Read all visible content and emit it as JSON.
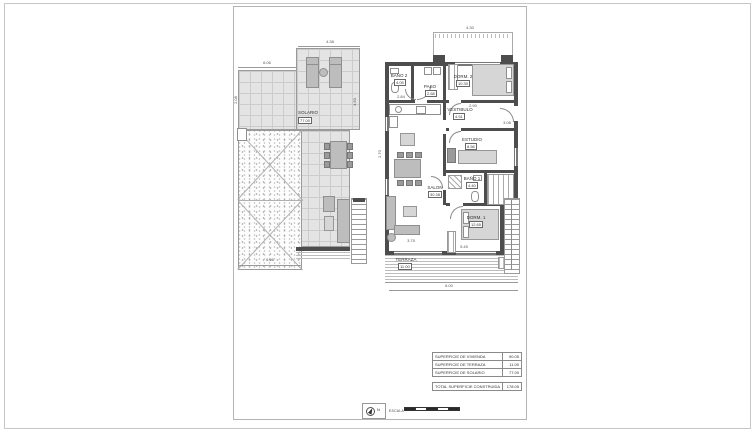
{
  "colors": {
    "wall": "#4d4d4d",
    "tile_fill": "#e4e4e4",
    "grid_line": "#cccccc",
    "furniture": "#bdbdbd",
    "paper": "#ffffff",
    "outline": "#9a9a9a",
    "text": "#3c3c3c",
    "scale_black": "#2a2a2a"
  },
  "solarium": {
    "label": "SOLARIO",
    "area": "77.00",
    "dims": {
      "top": "4.38",
      "upper": "6.06",
      "bottom": "6.06",
      "right": "4.50",
      "left": "2.08"
    }
  },
  "floor": {
    "rooms": {
      "bano2": {
        "name": "BAÑO 2",
        "area": "4.05"
      },
      "paso": {
        "name": "PASO",
        "area": "2.68"
      },
      "dorm2": {
        "name": "DORM. 2",
        "area": "10.30"
      },
      "vestibulo": {
        "name": "VESTIBULO",
        "area": "4.51"
      },
      "estudio": {
        "name": "ESTUDIO",
        "area": "8.56"
      },
      "bano1": {
        "name": "BAÑO 1",
        "area": "4.40"
      },
      "dorm1": {
        "name": "DORM. 1",
        "area": "12.65"
      },
      "salon": {
        "name": "SALON",
        "area": "30.38"
      },
      "terraza": {
        "name": "TERRAZA",
        "area": "11.00"
      }
    },
    "dims": {
      "left": "2.70",
      "bano2_below": "2.84",
      "dorm2_below": "2.90",
      "entry": "3.08",
      "patio": "4.30",
      "terraza_top": "5.45",
      "salon_bottom": "3.75",
      "bottom": "6.00"
    }
  },
  "area_table": {
    "rows": [
      {
        "label": "SUPERFICIE DE VIVIENDA",
        "value": "90.05"
      },
      {
        "label": "SUPERFICIE DE TERRAZA",
        "value": "11.00"
      },
      {
        "label": "SUPERFICIE DE SOLARIO",
        "value": "77.00"
      }
    ],
    "total": {
      "label": "TOTAL SUPERFICIE CONSTRUIDA",
      "value": "178.05"
    }
  },
  "scale_bar": {
    "label": "ESCALA",
    "north": "N"
  }
}
